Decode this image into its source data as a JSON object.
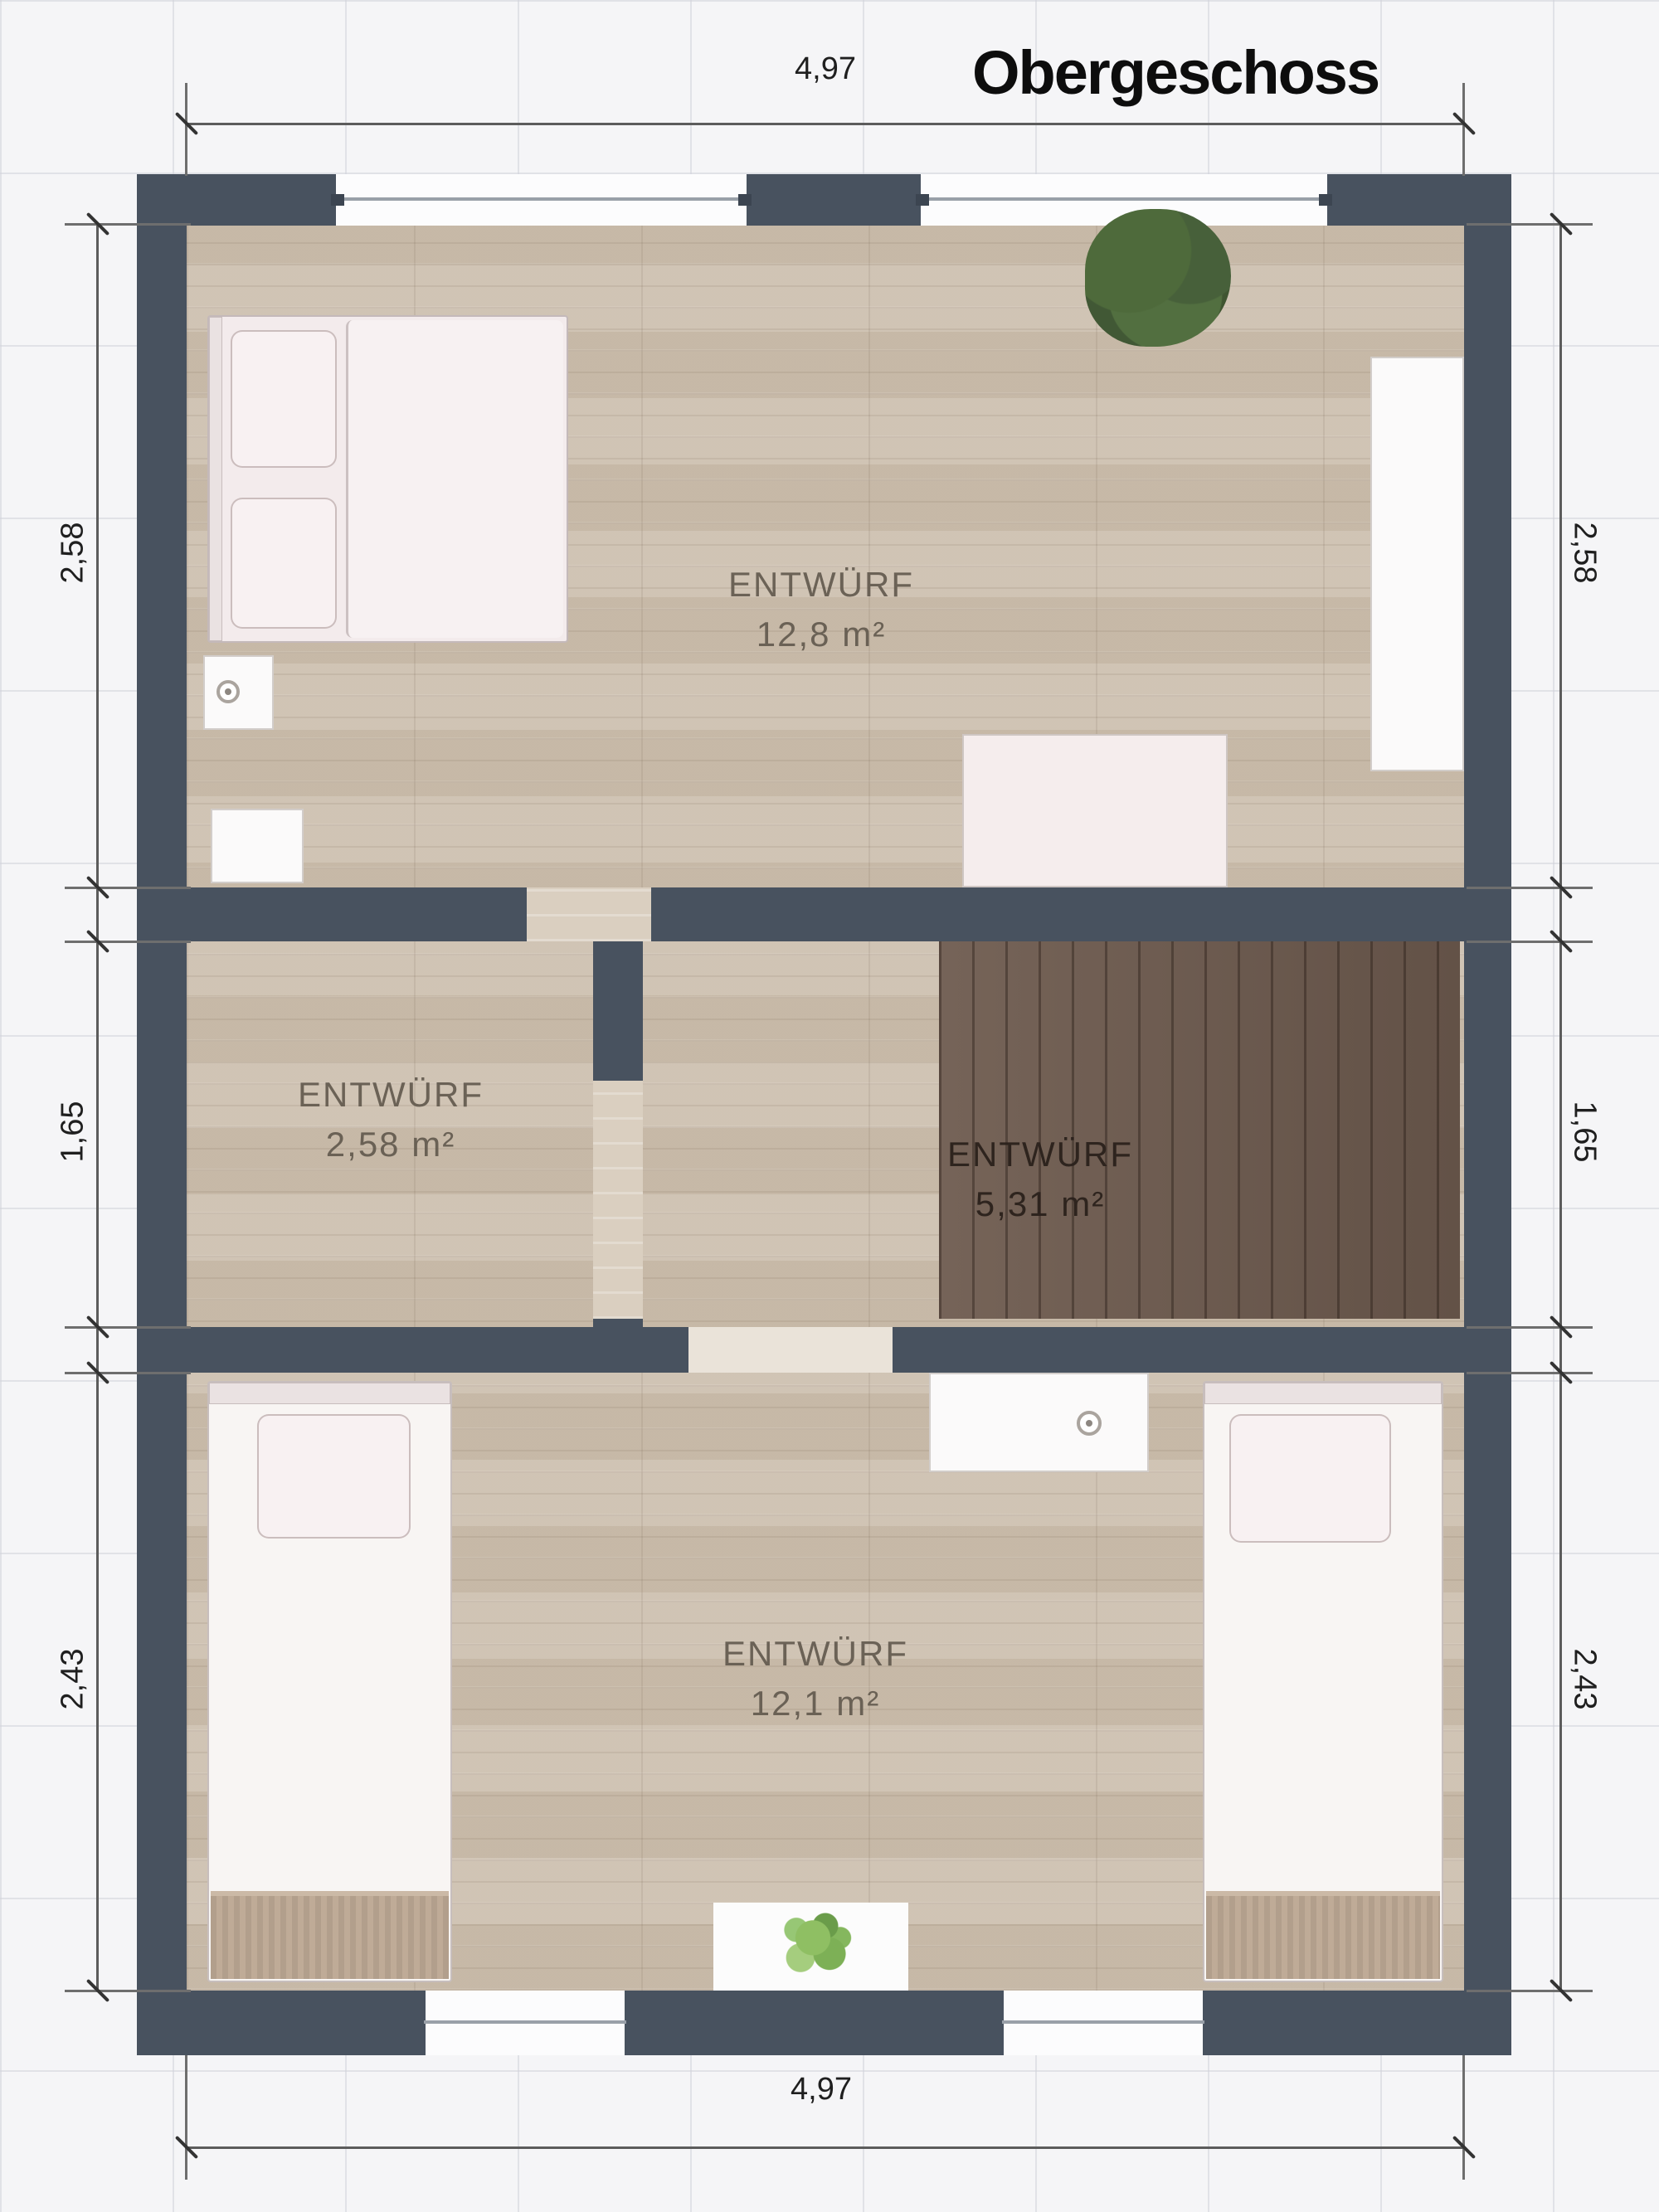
{
  "title": "Obergeschoss",
  "dimensions": {
    "top": "4,97",
    "bottom": "4,97",
    "left": [
      {
        "label": "2,58"
      },
      {
        "label": "1,65"
      },
      {
        "label": "2,43"
      }
    ],
    "right": [
      {
        "label": "2,58"
      },
      {
        "label": "1,65"
      },
      {
        "label": "2,43"
      }
    ]
  },
  "rooms": [
    {
      "name": "ENTWÜRF",
      "area": "12,8 m²"
    },
    {
      "name": "ENTWÜRF",
      "area": "2,58 m²"
    },
    {
      "name": "ENTWÜRF",
      "area": "5,31 m²"
    },
    {
      "name": "ENTWÜRF",
      "area": "12,1 m²"
    }
  ],
  "icons": {
    "large_plant": "plant-icon",
    "small_plant": "small-plant-icon",
    "faucet": "faucet-icon",
    "lamp": "lamp-icon"
  },
  "colors": {
    "wall": "#48525f",
    "floor_wood": "#cdc0af",
    "stairs_wood": "#6e5b4f",
    "window_white": "#fcfcfd",
    "plant_green": "#4c6639",
    "dimension_text": "#1f1f1f"
  }
}
